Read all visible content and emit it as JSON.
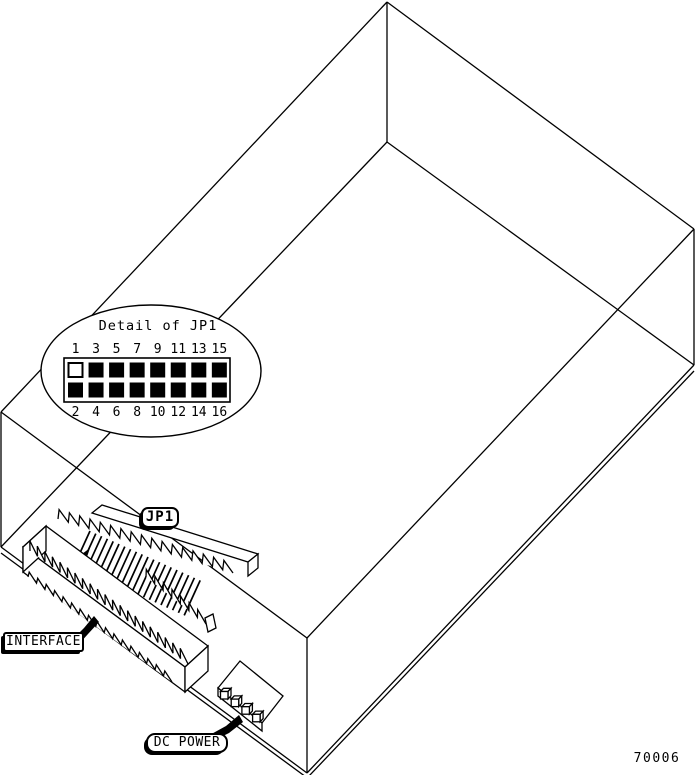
{
  "figure_number": "70006",
  "callout": {
    "title": "Detail of JP1",
    "top_pins": [
      {
        "label": "1",
        "filled": false
      },
      {
        "label": "3",
        "filled": true
      },
      {
        "label": "5",
        "filled": true
      },
      {
        "label": "7",
        "filled": true
      },
      {
        "label": "9",
        "filled": true
      },
      {
        "label": "11",
        "filled": true
      },
      {
        "label": "13",
        "filled": true
      },
      {
        "label": "15",
        "filled": true
      }
    ],
    "bottom_pins": [
      {
        "label": "2",
        "filled": true
      },
      {
        "label": "4",
        "filled": true
      },
      {
        "label": "6",
        "filled": true
      },
      {
        "label": "8",
        "filled": true
      },
      {
        "label": "10",
        "filled": true
      },
      {
        "label": "12",
        "filled": true
      },
      {
        "label": "14",
        "filled": true
      },
      {
        "label": "16",
        "filled": true
      }
    ]
  },
  "labels": {
    "jp1": "JP1",
    "interface": "INTERFACE",
    "dc_power": "DC POWER"
  },
  "colors": {
    "ink": "#000000",
    "paper": "#ffffff"
  }
}
